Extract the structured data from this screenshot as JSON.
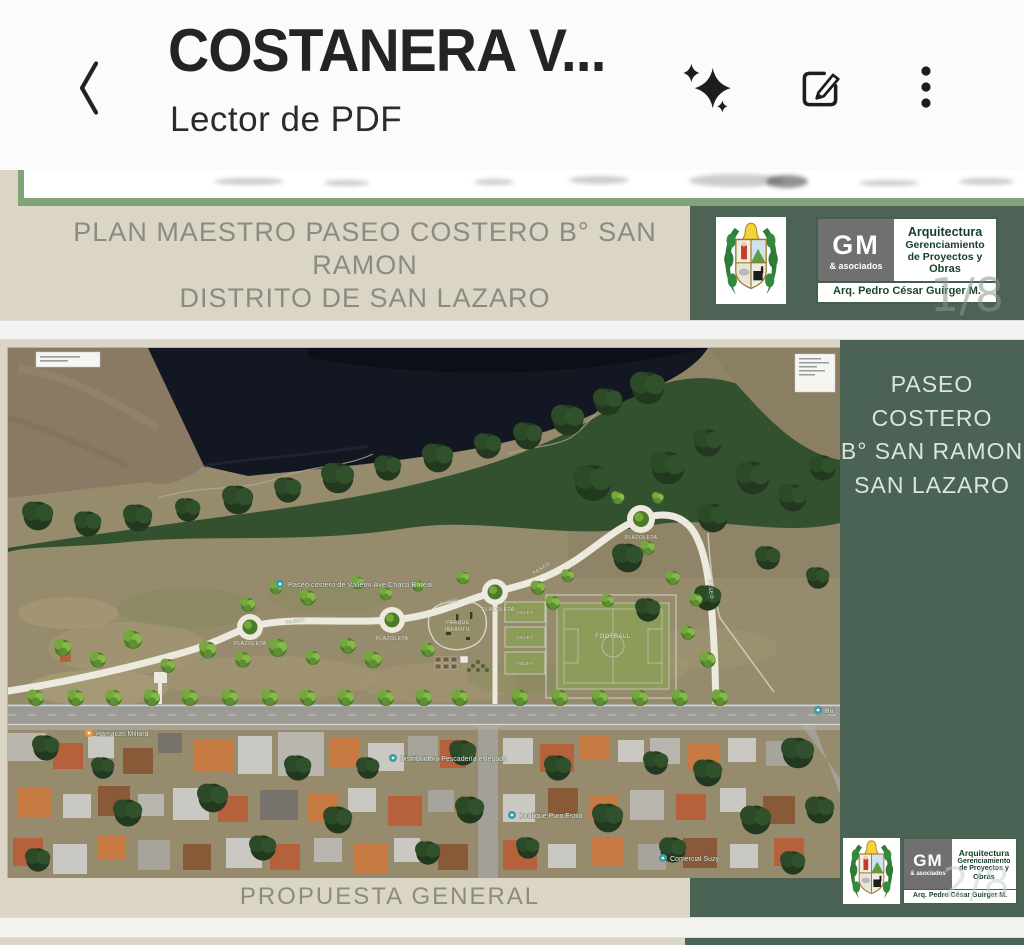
{
  "app_bar": {
    "title": "COSTANERA V...",
    "subtitle": "Lector de PDF",
    "icons": {
      "back": "chevron-left",
      "ai": "sparkles",
      "edit": "edit-compose",
      "menu": "more-vertical"
    }
  },
  "document": {
    "page1": {
      "heading_line1": "PLAN MAESTRO PASEO COSTERO B° SAN RAMON",
      "heading_line2": "DISTRITO DE SAN LAZARO",
      "page_indicator": "1/8"
    },
    "page2": {
      "sidebar_line1": "PASEO",
      "sidebar_line2": "COSTERO",
      "sidebar_line3": "B° SAN RAMON",
      "sidebar_line4": "SAN LAZARO",
      "caption": "PROPUESTA GENERAL",
      "page_indicator": "2/8"
    },
    "firm": {
      "initials": "GM",
      "tagline": "& asociados",
      "line1": "Arquitectura",
      "line2": "Gerenciamiento",
      "line3": "de Proyectos y",
      "line4": "Obras",
      "architect": "Arq. Pedro César Guirger M."
    },
    "map": {
      "route_label": "Paseo costero de Vallemí Ave Chaco Boreal",
      "paseo": "PASEO",
      "plazoleta": "PLAZOLETA",
      "parque_line1": "PARQUE",
      "parque_line2": "INFANTIL",
      "voley": "VOLEY",
      "football": "FOOTBALL",
      "poi_hotel": "Hamacas Milford",
      "poi_distribuidora": "Distribuidora Pescadería el legado",
      "poi_boutique": "Boutique Puro Estilo",
      "poi_comercial": "Comercial Suzy",
      "poi_truncated": "Bu"
    }
  },
  "colors": {
    "page_beige": "#dbd5c5",
    "panel_green": "#4b6354",
    "heading_gray": "#8b8b80",
    "border_green": "#82a27a"
  }
}
